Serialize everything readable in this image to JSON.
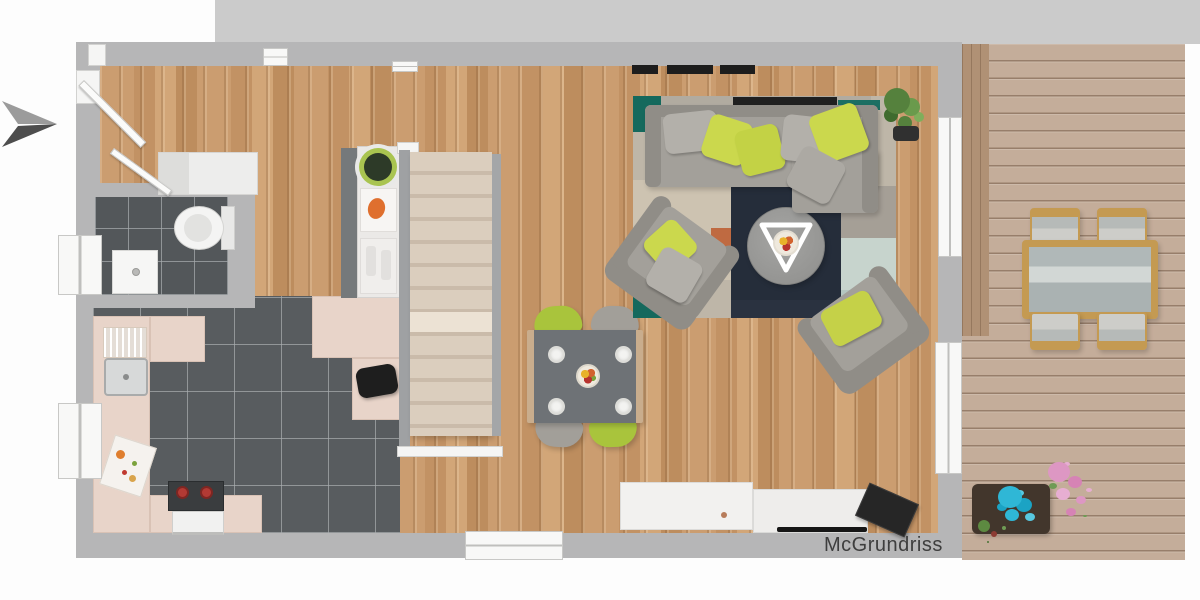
{
  "watermark": {
    "text": "McGrundriss"
  },
  "palette": {
    "band": "#cbcbcb",
    "wall": "#b6b6b7",
    "wood1": "#cb9d70",
    "wood2": "#c29264",
    "wood3": "#d2a678",
    "deck": "#c4ad9a",
    "tilebath": "#53575a",
    "tilekitchen": "#585c5f",
    "counter": "#e8d4c9",
    "stair": "#dbcebe",
    "rail": "#9fa1a3",
    "sofa": "#a3a09a",
    "sofadark": "#908d87",
    "pgreen": "#cbd84d",
    "pgray": "#b3b0aa",
    "rteal": "#15695d",
    "rnavy": "#252d3a",
    "rbeige": "#cdc3b1",
    "rorange": "#bf6a41",
    "rmint": "#c7d4cd",
    "rgray": "#a59f96",
    "dtable": "#6e7276",
    "cgreen": "#a9c43c",
    "cgray": "#a29f99",
    "wicker": "#c49a52",
    "cushion": "#cdcdc9",
    "planter": "#42362c",
    "cyan": "#2fb7d6",
    "pink": "#dd97c3",
    "plant": "#55813d",
    "dark": "#1d1d1d",
    "burner": "#b23a34",
    "fruit": "#df6f2e",
    "text": "#3e3e3e"
  },
  "icons": {
    "north_arrow": "direction-arrow"
  }
}
